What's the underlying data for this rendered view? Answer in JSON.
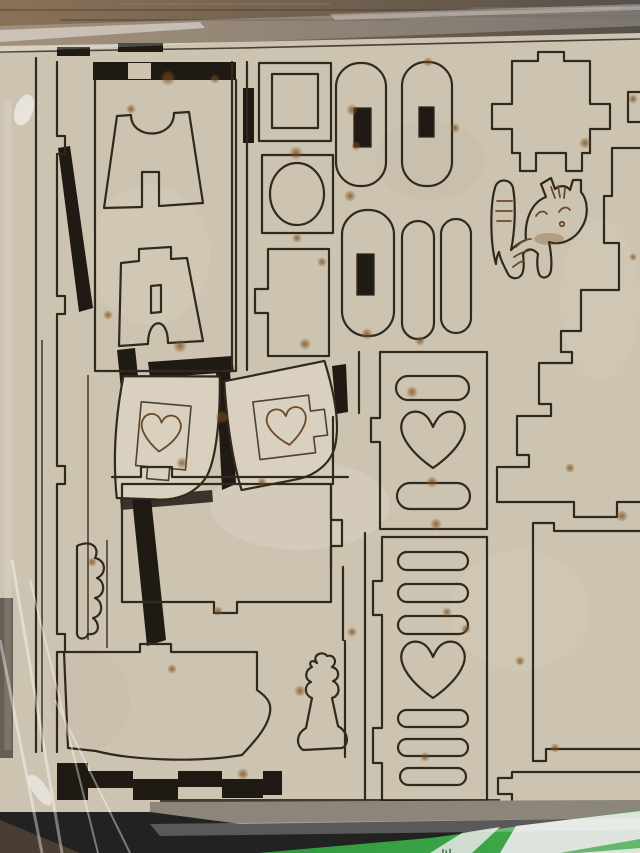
{
  "scene": {
    "type": "photograph",
    "subject": "laser-cut MDF dollhouse furniture kit sheet shrink-wrapped in clear plastic on a wooden table",
    "label": {
      "visible_text": "ЗЄ ІИ"
    },
    "pieces": [
      "trestle-stand-1",
      "trestle-stand-2",
      "picture-frame",
      "mirror-frame",
      "tab-rectangle",
      "stadium-with-slot-1",
      "stadium-with-slot-2",
      "stadium-with-slot-3",
      "pill-1",
      "pill-2",
      "chair-bracket",
      "cat-figure",
      "staircase-cut",
      "tilted-heart-chair-side-left",
      "tilted-heart-chair-side-right",
      "heart-slat-headboard",
      "heart-slat-footboard",
      "bed-base",
      "sofa",
      "scallop-plant",
      "small-plant",
      "bottom-right-panel",
      "long-strip"
    ],
    "colors": {
      "wood_left": "#8a7156",
      "wood_right": "#57504a",
      "wood_corner": "#4a3e33",
      "sheet": "#cdc3b1",
      "sheet_light": "#d9d0bf",
      "sheet_dark": "#bdb29e",
      "line": "#32291d",
      "engrave": "#6b4a28",
      "gap_dark": "#1f1a14",
      "shadow_band": "#8b857a",
      "label_green": "#45ab4d",
      "label_light": "#dfe3de",
      "burn": "#7a4a1a",
      "plastic": "#ffffff"
    }
  }
}
